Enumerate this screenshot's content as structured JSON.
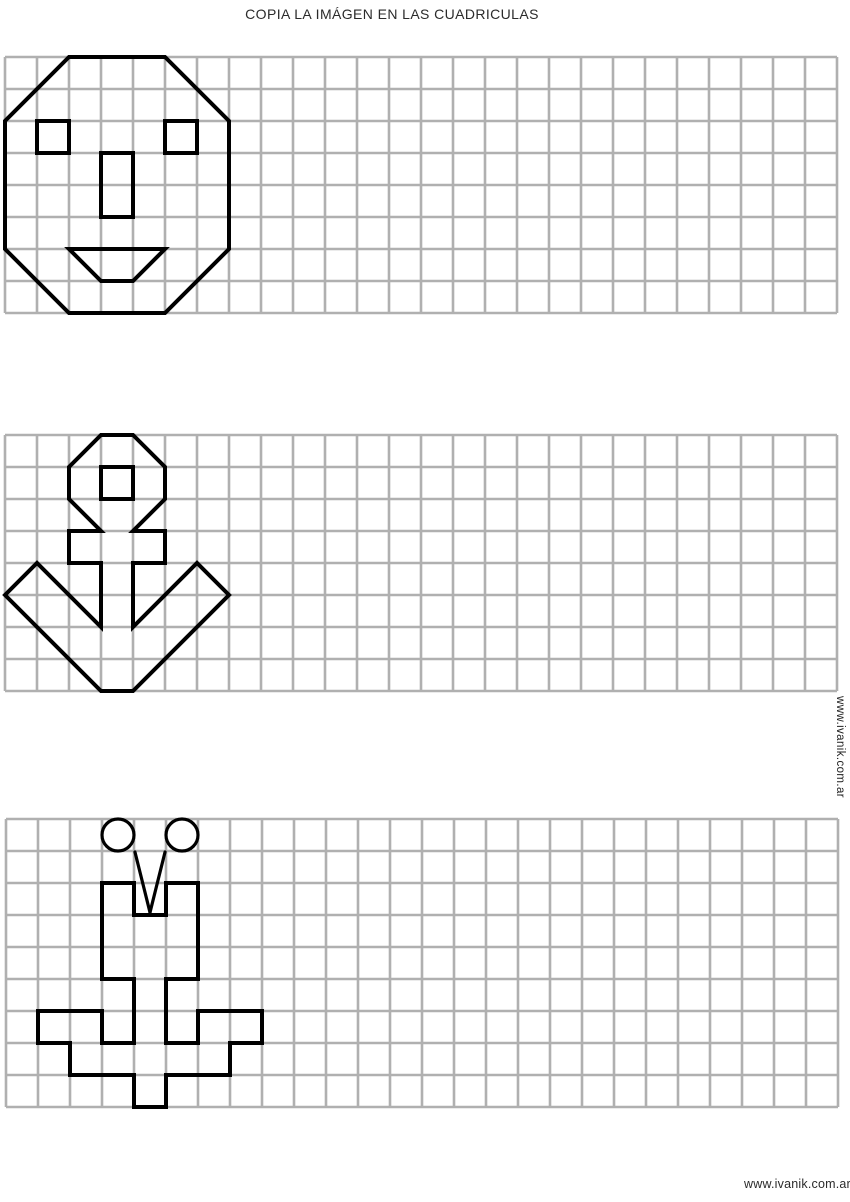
{
  "title": "COPIA LA IMÁGEN EN LAS CUADRICULAS",
  "watermark_side": "www.ivanik.com.ar",
  "watermark_bottom": "www.ivanik.com.ar",
  "colors": {
    "background": "#ffffff",
    "grid": "#b0b0b0",
    "figure": "#000000",
    "text": "#2b2b2b"
  },
  "grid": {
    "cell": 32,
    "cols": 26,
    "grid_stroke": 2.6,
    "figure_stroke": 4
  },
  "panels": [
    {
      "name": "face",
      "x": 5,
      "y": 57,
      "rows": 8,
      "shapes": [
        {
          "name": "head-outline",
          "type": "polygon",
          "points": [
            [
              2,
              0
            ],
            [
              5,
              0
            ],
            [
              7,
              2
            ],
            [
              7,
              6
            ],
            [
              5,
              8
            ],
            [
              2,
              8
            ],
            [
              0,
              6
            ],
            [
              0,
              2
            ]
          ]
        },
        {
          "name": "left-eye",
          "type": "rect",
          "x": 1,
          "y": 2,
          "w": 1,
          "h": 1
        },
        {
          "name": "right-eye",
          "type": "rect",
          "x": 5,
          "y": 2,
          "w": 1,
          "h": 1
        },
        {
          "name": "nose",
          "type": "rect",
          "x": 3,
          "y": 3,
          "w": 1,
          "h": 2
        },
        {
          "name": "mouth",
          "type": "polygon",
          "points": [
            [
              2,
              6
            ],
            [
              5,
              6
            ],
            [
              4,
              7
            ],
            [
              3,
              7
            ]
          ]
        }
      ]
    },
    {
      "name": "anchor",
      "x": 5,
      "y": 435,
      "rows": 8,
      "shapes": [
        {
          "name": "anchor-outline",
          "type": "polygon",
          "points": [
            [
              3,
              0
            ],
            [
              4,
              0
            ],
            [
              5,
              1
            ],
            [
              5,
              2
            ],
            [
              4,
              3
            ],
            [
              5,
              3
            ],
            [
              5,
              4
            ],
            [
              4,
              4
            ],
            [
              4,
              6
            ],
            [
              6,
              4
            ],
            [
              7,
              5
            ],
            [
              4,
              8
            ],
            [
              3,
              8
            ],
            [
              0,
              5
            ],
            [
              1,
              4
            ],
            [
              3,
              6
            ],
            [
              3,
              4
            ],
            [
              2,
              4
            ],
            [
              2,
              3
            ],
            [
              3,
              3
            ],
            [
              2,
              2
            ],
            [
              2,
              1
            ]
          ]
        },
        {
          "name": "ring-hole",
          "type": "rect",
          "x": 3,
          "y": 1,
          "w": 1,
          "h": 1
        }
      ]
    },
    {
      "name": "bug",
      "x": 6,
      "y": 819,
      "rows": 9,
      "shapes": [
        {
          "name": "left-antenna-ball",
          "type": "circle",
          "cx": 3.5,
          "cy": 0.5,
          "r": 0.5
        },
        {
          "name": "right-antenna-ball",
          "type": "circle",
          "cx": 5.5,
          "cy": 0.5,
          "r": 0.5
        },
        {
          "name": "left-antenna",
          "type": "line",
          "x1": 4.03,
          "y1": 1.03,
          "x2": 4.5,
          "y2": 2.92
        },
        {
          "name": "right-antenna",
          "type": "line",
          "x1": 4.97,
          "y1": 1.03,
          "x2": 4.5,
          "y2": 2.92
        },
        {
          "name": "body-outline",
          "type": "polygon",
          "points": [
            [
              3,
              2
            ],
            [
              4,
              2
            ],
            [
              4,
              3
            ],
            [
              5,
              3
            ],
            [
              5,
              2
            ],
            [
              6,
              2
            ],
            [
              6,
              5
            ],
            [
              5,
              5
            ],
            [
              5,
              7
            ],
            [
              6,
              7
            ],
            [
              6,
              6
            ],
            [
              8,
              6
            ],
            [
              8,
              7
            ],
            [
              7,
              7
            ],
            [
              7,
              8
            ],
            [
              5,
              8
            ],
            [
              5,
              9
            ],
            [
              4,
              9
            ],
            [
              4,
              8
            ],
            [
              2,
              8
            ],
            [
              2,
              7
            ],
            [
              1,
              7
            ],
            [
              1,
              6
            ],
            [
              3,
              6
            ],
            [
              3,
              7
            ],
            [
              4,
              7
            ],
            [
              4,
              5
            ],
            [
              3,
              5
            ]
          ]
        }
      ]
    }
  ]
}
